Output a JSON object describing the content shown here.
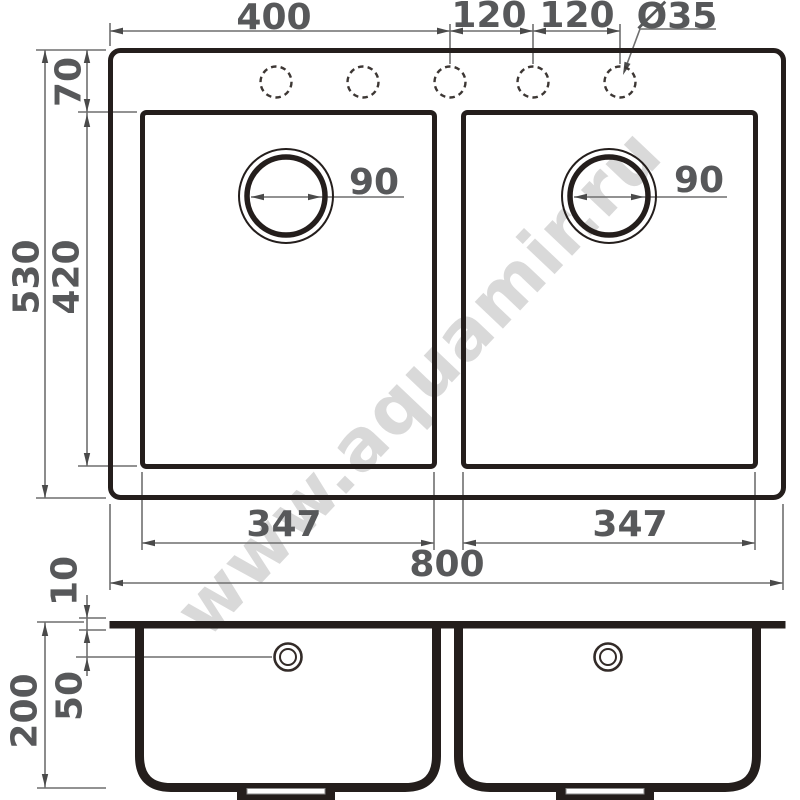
{
  "watermark": "www.aquamir.ru",
  "colors": {
    "drawing_line": "#241e1c",
    "dimension_line": "#6f6f6f",
    "dimension_text": "#57585a",
    "watermark_text": "#d9d9d9"
  },
  "top_view": {
    "labels": {
      "width_to_center_hole": "400",
      "hole_spacing_1": "120",
      "hole_spacing_2": "120",
      "hole_diameter": "Ø35",
      "overall_depth": "530",
      "rim_to_bowl": "70",
      "bowl_depth": "420",
      "drain_left": "90",
      "drain_right": "90",
      "bowl_width_left": "347",
      "bowl_width_right": "347",
      "overall_width": "800"
    },
    "tap_holes_count": 5,
    "bowls_count": 2
  },
  "side_view": {
    "labels": {
      "rim_thickness": "10",
      "overflow_offset": "50",
      "bowl_height": "200"
    }
  }
}
